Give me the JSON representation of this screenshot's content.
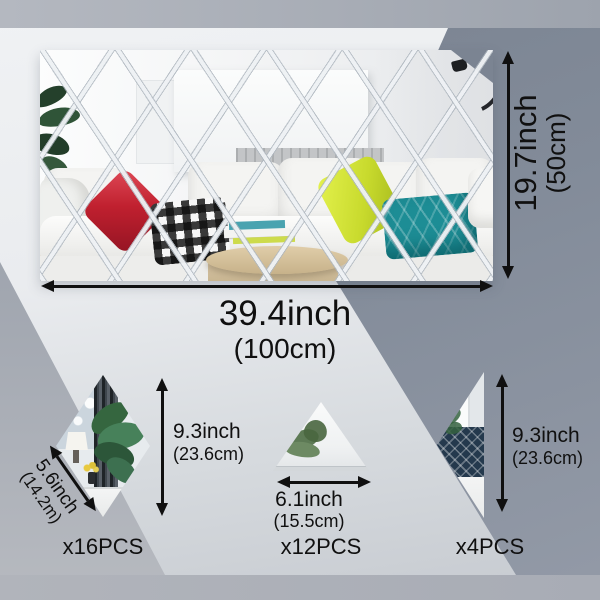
{
  "title": "Diamond mirror wall sticker dimension diagram",
  "main_mirror": {
    "height_label": "19.7inch",
    "height_sub": "(50cm)",
    "width_label": "39.4inch",
    "width_sub": "(100cm)"
  },
  "diamond_piece": {
    "edge_label": "5.6inch",
    "edge_sub": "(14.2m)",
    "height_label": "9.3inch",
    "height_sub": "(23.6cm)",
    "count_label": "x16PCS"
  },
  "triangle_piece": {
    "width_label": "6.1inch",
    "width_sub": "(15.5cm)",
    "count_label": "x12PCS"
  },
  "half_diamond_piece": {
    "height_label": "9.3inch",
    "height_sub": "(23.6cm)",
    "count_label": "x4PCS"
  },
  "colors": {
    "text": "#101010",
    "dark_band": "#7d8694",
    "light_background": "#e9ebee",
    "gray_strip": "#aab0b9",
    "red_pillow": "#c0202f",
    "chartreuse_pillow": "#c8da2d",
    "teal_pillow": "#1d8d95"
  }
}
